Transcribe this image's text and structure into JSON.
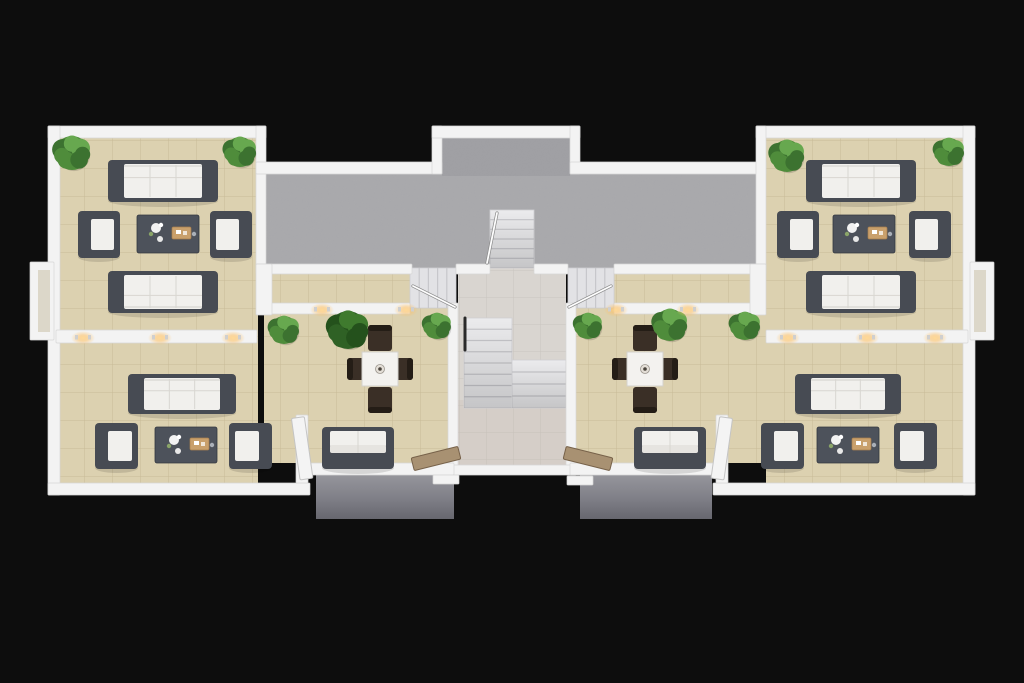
{
  "scene": {
    "canvas": {
      "w": 1024,
      "h": 683,
      "bg": "#0d0d0d"
    },
    "palette": {
      "wall": "#f3f3f3",
      "wallEdge": "#d6d6d6",
      "wallInset": "#c9c0a6",
      "concrete": "#a8a8ab",
      "concreteBump": "#9e9ea2",
      "stair": "#ebebed",
      "stairSide": "#e2e2e5",
      "stairLine": "#c7c7cb",
      "sofaFrame": "#474b53",
      "cushion": "#f1f0ed",
      "seam": "#d8d6d1",
      "coffee": "#4d525b",
      "coffeeEdge": "#343840",
      "tray": "#c9a06c",
      "chairWood": "#3a2f26",
      "chairBack": "#241d16",
      "tableTop": "#f3f2ef",
      "tableEdge": "#d3d1cc",
      "doorWhite": "#f4f4f4",
      "doorWood": "#a8917246",
      "doorWoodFill": "#a89172",
      "doorWoodEdge": "#77624a",
      "potColor": "#6b5b46",
      "glowCore": "#ffd894",
      "greens": [
        "#4f8c3b",
        "#3c7230",
        "#67a84f"
      ],
      "greensDark": [
        "#2f6125",
        "#24511c",
        "#3f7a2e"
      ]
    },
    "floors": [
      {
        "name": "floor-left-wing",
        "type": "beige",
        "x": 58,
        "y": 138,
        "w": 200,
        "h": 345
      },
      {
        "name": "floor-left-dining",
        "type": "beige",
        "x": 264,
        "y": 268,
        "w": 184,
        "h": 195
      },
      {
        "name": "floor-right-dining",
        "type": "beige",
        "x": 576,
        "y": 268,
        "w": 192,
        "h": 195
      },
      {
        "name": "floor-right-wing",
        "type": "beige",
        "x": 766,
        "y": 138,
        "w": 200,
        "h": 345
      },
      {
        "name": "floor-bay-left",
        "type": "beige",
        "x": 38,
        "y": 270,
        "w": 20,
        "h": 62
      },
      {
        "name": "floor-bay-right",
        "type": "beige",
        "x": 966,
        "y": 270,
        "w": 20,
        "h": 62
      },
      {
        "name": "floor-terrace",
        "type": "concrete",
        "x": 266,
        "y": 172,
        "w": 492,
        "h": 96
      },
      {
        "name": "floor-terrace-bump",
        "type": "concrete2",
        "x": 442,
        "y": 136,
        "w": 128,
        "h": 40
      },
      {
        "name": "floor-hall",
        "type": "hall",
        "x": 458,
        "y": 268,
        "w": 108,
        "h": 200
      },
      {
        "name": "floor-hall-lower-tint",
        "type": "tint",
        "x": 458,
        "y": 400,
        "w": 108,
        "h": 68,
        "fill": "#c9b2a8",
        "opacity": 0.2
      },
      {
        "name": "floor-balcony-left",
        "type": "slab",
        "x": 316,
        "y": 472,
        "w": 138,
        "h": 47
      },
      {
        "name": "floor-balcony-right",
        "type": "slab",
        "x": 580,
        "y": 472,
        "w": 132,
        "h": 47
      }
    ],
    "stairs": [
      {
        "name": "stair-terrace",
        "x": 490,
        "y": 210,
        "w": 44,
        "h": 58,
        "dir": "h",
        "steps": 6,
        "shade": true
      },
      {
        "name": "stair-main-upper",
        "x": 464,
        "y": 318,
        "w": 48,
        "h": 90,
        "dir": "h",
        "steps": 8,
        "shade": true
      },
      {
        "name": "stair-main-lower",
        "x": 512,
        "y": 360,
        "w": 54,
        "h": 48,
        "dir": "h",
        "steps": 4,
        "shade": true
      },
      {
        "name": "stair-side-left",
        "x": 410,
        "y": 268,
        "w": 46,
        "h": 40,
        "dir": "v",
        "steps": 5,
        "side": true
      },
      {
        "name": "stair-side-right",
        "x": 568,
        "y": 268,
        "w": 46,
        "h": 40,
        "dir": "v",
        "steps": 5,
        "side": true
      }
    ],
    "walls": [
      {
        "name": "wall-top-left-wing",
        "x": 48,
        "y": 126,
        "w": 218,
        "h": 12
      },
      {
        "name": "wall-left-outer",
        "x": 48,
        "y": 126,
        "w": 12,
        "h": 369
      },
      {
        "name": "wall-bottom-left-wing",
        "x": 48,
        "y": 483,
        "w": 262,
        "h": 12
      },
      {
        "name": "wall-sep-left-terrace",
        "x": 256,
        "y": 126,
        "w": 10,
        "h": 142
      },
      {
        "name": "wall-terrace-top-left",
        "x": 256,
        "y": 162,
        "w": 186,
        "h": 12
      },
      {
        "name": "wall-bump-left",
        "x": 432,
        "y": 126,
        "w": 10,
        "h": 48
      },
      {
        "name": "wall-bump-top",
        "x": 432,
        "y": 126,
        "w": 148,
        "h": 12
      },
      {
        "name": "wall-bump-right",
        "x": 570,
        "y": 126,
        "w": 10,
        "h": 48
      },
      {
        "name": "wall-terrace-top-right",
        "x": 570,
        "y": 162,
        "w": 196,
        "h": 12
      },
      {
        "name": "wall-top-right-wing",
        "x": 756,
        "y": 126,
        "w": 219,
        "h": 12
      },
      {
        "name": "wall-right-outer",
        "x": 963,
        "y": 126,
        "w": 12,
        "h": 369
      },
      {
        "name": "wall-bottom-right-wing",
        "x": 713,
        "y": 483,
        "w": 262,
        "h": 12
      },
      {
        "name": "wall-sep-right-terrace",
        "x": 756,
        "y": 126,
        "w": 10,
        "h": 142
      },
      {
        "name": "wall-under-terrace-left",
        "x": 256,
        "y": 264,
        "w": 156,
        "h": 10
      },
      {
        "name": "wall-under-terrace-hall-left",
        "x": 456,
        "y": 264,
        "w": 34,
        "h": 10
      },
      {
        "name": "wall-under-terrace-hall-right",
        "x": 534,
        "y": 264,
        "w": 34,
        "h": 10
      },
      {
        "name": "wall-under-terrace-right",
        "x": 614,
        "y": 264,
        "w": 152,
        "h": 10
      },
      {
        "name": "wall-corridor-south-left",
        "x": 268,
        "y": 303,
        "w": 142,
        "h": 11
      },
      {
        "name": "wall-corridor-south-right",
        "x": 614,
        "y": 303,
        "w": 142,
        "h": 11
      },
      {
        "name": "wall-chunk-left",
        "x": 256,
        "y": 264,
        "w": 16,
        "h": 51
      },
      {
        "name": "wall-chunk-right",
        "x": 750,
        "y": 264,
        "w": 16,
        "h": 51
      },
      {
        "name": "wall-hall-left",
        "x": 448,
        "y": 303,
        "w": 10,
        "h": 172
      },
      {
        "name": "wall-hall-right",
        "x": 566,
        "y": 303,
        "w": 10,
        "h": 172
      },
      {
        "name": "wall-hall-bottom",
        "x": 448,
        "y": 465,
        "w": 128,
        "h": 10
      },
      {
        "name": "wall-lights-left",
        "x": 56,
        "y": 330,
        "w": 201,
        "h": 13
      },
      {
        "name": "wall-lights-right",
        "x": 766,
        "y": 330,
        "w": 202,
        "h": 13
      },
      {
        "name": "wall-dining-stub-left",
        "x": 296,
        "y": 415,
        "w": 12,
        "h": 68
      },
      {
        "name": "wall-dining-stub-right",
        "x": 716,
        "y": 415,
        "w": 12,
        "h": 68
      },
      {
        "name": "wall-dining-bottom-left",
        "x": 308,
        "y": 463,
        "w": 146,
        "h": 12
      },
      {
        "name": "wall-dining-bottom-right",
        "x": 570,
        "y": 463,
        "w": 146,
        "h": 12
      },
      {
        "name": "wall-bay-left",
        "x": 30,
        "y": 262,
        "w": 24,
        "h": 78
      },
      {
        "name": "wall-bay-right",
        "x": 970,
        "y": 262,
        "w": 24,
        "h": 78
      },
      {
        "name": "threshold-balcony-left",
        "x": 433,
        "y": 475,
        "w": 26,
        "h": 9
      },
      {
        "name": "threshold-balcony-right",
        "x": 567,
        "y": 476,
        "w": 26,
        "h": 9
      }
    ],
    "bay_insets": [
      {
        "name": "bay-inset-left",
        "x": 38,
        "y": 270,
        "w": 12,
        "h": 62
      },
      {
        "name": "bay-inset-right",
        "x": 974,
        "y": 270,
        "w": 12,
        "h": 62
      }
    ],
    "railings": [
      {
        "name": "railing-terrace-stair",
        "x1": 497,
        "y1": 213,
        "x2": 487,
        "y2": 263
      },
      {
        "name": "railing-side-left",
        "x1": 413,
        "y1": 286,
        "x2": 455,
        "y2": 307
      },
      {
        "name": "railing-side-right",
        "x1": 611,
        "y1": 286,
        "x2": 569,
        "y2": 307
      },
      {
        "name": "railing-main-stair",
        "x1": 465,
        "y1": 318,
        "x2": 465,
        "y2": 350,
        "dark": true
      }
    ],
    "sofas": [
      {
        "name": "sofa-left-upper-north",
        "x": 108,
        "y": 160,
        "w": 110,
        "h": 42,
        "back": "n"
      },
      {
        "name": "sofa-left-upper-south",
        "x": 108,
        "y": 271,
        "w": 110,
        "h": 42,
        "back": "s"
      },
      {
        "name": "sofa-left-lower",
        "x": 128,
        "y": 374,
        "w": 108,
        "h": 40,
        "back": "n"
      },
      {
        "name": "sofa-right-upper-north",
        "x": 806,
        "y": 160,
        "w": 110,
        "h": 42,
        "back": "n"
      },
      {
        "name": "sofa-right-upper-south",
        "x": 806,
        "y": 271,
        "w": 110,
        "h": 42,
        "back": "s"
      },
      {
        "name": "sofa-right-lower",
        "x": 795,
        "y": 374,
        "w": 106,
        "h": 40,
        "back": "n"
      },
      {
        "name": "sofa-balcony-left",
        "x": 322,
        "y": 427,
        "w": 72,
        "h": 42,
        "back": "s",
        "small": true
      },
      {
        "name": "sofa-balcony-right",
        "x": 634,
        "y": 427,
        "w": 72,
        "h": 42,
        "back": "s",
        "small": true
      }
    ],
    "armchairs": [
      {
        "name": "armchair-left-upper-west",
        "x": 78,
        "y": 211,
        "w": 42,
        "h": 47,
        "face": "e"
      },
      {
        "name": "armchair-left-upper-east",
        "x": 210,
        "y": 211,
        "w": 42,
        "h": 47,
        "face": "w"
      },
      {
        "name": "armchair-left-lower-west",
        "x": 95,
        "y": 423,
        "w": 43,
        "h": 46,
        "face": "e"
      },
      {
        "name": "armchair-left-lower-east",
        "x": 229,
        "y": 423,
        "w": 43,
        "h": 46,
        "face": "w"
      },
      {
        "name": "armchair-right-upper-west",
        "x": 777,
        "y": 211,
        "w": 42,
        "h": 47,
        "face": "e"
      },
      {
        "name": "armchair-right-upper-east",
        "x": 909,
        "y": 211,
        "w": 42,
        "h": 47,
        "face": "w"
      },
      {
        "name": "armchair-right-lower-west",
        "x": 761,
        "y": 423,
        "w": 43,
        "h": 46,
        "face": "e"
      },
      {
        "name": "armchair-right-lower-east",
        "x": 894,
        "y": 423,
        "w": 43,
        "h": 46,
        "face": "w"
      }
    ],
    "coffee_tables": [
      {
        "name": "coffee-table-left-upper",
        "x": 137,
        "y": 215,
        "w": 62,
        "h": 38
      },
      {
        "name": "coffee-table-left-lower",
        "x": 155,
        "y": 427,
        "w": 62,
        "h": 36
      },
      {
        "name": "coffee-table-right-upper",
        "x": 833,
        "y": 215,
        "w": 62,
        "h": 38
      },
      {
        "name": "coffee-table-right-lower",
        "x": 817,
        "y": 427,
        "w": 62,
        "h": 36
      }
    ],
    "dining_sets": [
      {
        "name": "dining-set-left",
        "cx": 380,
        "cy": 369
      },
      {
        "name": "dining-set-right",
        "cx": 645,
        "cy": 369
      }
    ],
    "plants": [
      {
        "name": "plant-left-wing-nw",
        "cx": 72,
        "cy": 153,
        "r": 17,
        "shade": "normal"
      },
      {
        "name": "plant-left-wing-ne",
        "cx": 240,
        "cy": 152,
        "r": 15,
        "shade": "normal"
      },
      {
        "name": "plant-left-opening",
        "cx": 284,
        "cy": 330,
        "r": 14,
        "shade": "normal"
      },
      {
        "name": "plant-left-dining",
        "cx": 348,
        "cy": 330,
        "r": 19,
        "shade": "dark"
      },
      {
        "name": "plant-left-hall-door",
        "cx": 437,
        "cy": 326,
        "r": 13,
        "shade": "normal"
      },
      {
        "name": "plant-right-hall-door",
        "cx": 588,
        "cy": 326,
        "r": 13,
        "shade": "normal"
      },
      {
        "name": "plant-right-dining",
        "cx": 670,
        "cy": 325,
        "r": 16,
        "shade": "normal"
      },
      {
        "name": "plant-right-opening",
        "cx": 745,
        "cy": 326,
        "r": 14,
        "shade": "normal"
      },
      {
        "name": "plant-right-wing-nw",
        "cx": 787,
        "cy": 156,
        "r": 16,
        "shade": "normal"
      },
      {
        "name": "plant-right-wing-ne",
        "cx": 949,
        "cy": 152,
        "r": 14,
        "shade": "normal"
      }
    ],
    "lights": [
      {
        "name": "wall-light",
        "cx": 83,
        "cy": 338
      },
      {
        "name": "wall-light",
        "cx": 160,
        "cy": 338
      },
      {
        "name": "wall-light",
        "cx": 233,
        "cy": 338
      },
      {
        "name": "wall-light",
        "cx": 788,
        "cy": 338
      },
      {
        "name": "wall-light",
        "cx": 867,
        "cy": 338
      },
      {
        "name": "wall-light",
        "cx": 935,
        "cy": 338
      },
      {
        "name": "wall-light",
        "cx": 322,
        "cy": 310
      },
      {
        "name": "wall-light",
        "cx": 406,
        "cy": 310
      },
      {
        "name": "wall-light",
        "cx": 616,
        "cy": 310
      },
      {
        "name": "wall-light",
        "cx": 688,
        "cy": 310
      }
    ],
    "doors": [
      {
        "name": "door-left-unit",
        "x": 300,
        "y": 417,
        "w": 13,
        "h": 62,
        "angle": -8,
        "type": "white"
      },
      {
        "name": "door-right-unit",
        "x": 711,
        "y": 417,
        "w": 13,
        "h": 62,
        "angle": 8,
        "type": "white"
      },
      {
        "name": "door-balcony-left",
        "x": 412,
        "y": 452,
        "w": 48,
        "h": 13,
        "angle": -14,
        "type": "wood"
      },
      {
        "name": "door-balcony-right",
        "x": 564,
        "y": 452,
        "w": 48,
        "h": 13,
        "angle": 14,
        "type": "wood"
      }
    ]
  }
}
